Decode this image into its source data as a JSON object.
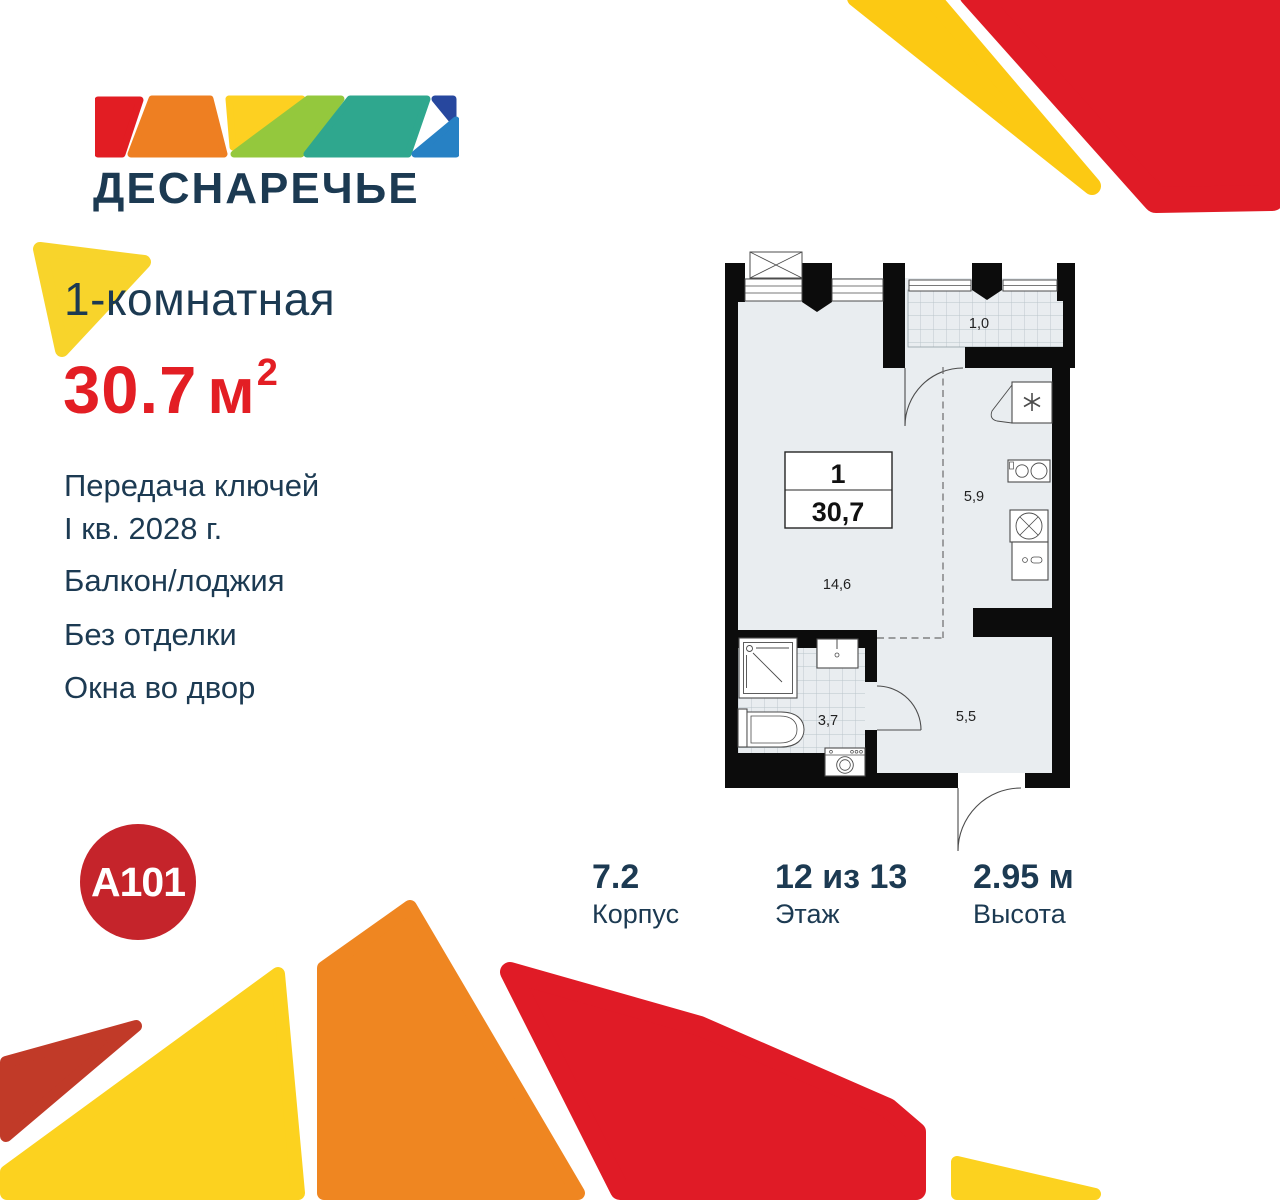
{
  "brand": {
    "project_name": "ДЕСНАРЕЧЬЕ",
    "developer_logo": "A101",
    "colors": {
      "navy": "#1c3a52",
      "accent_red": "#e31e24",
      "badge_red": "#c5242b",
      "yellow": "#fcd21f",
      "orange": "#ef8621",
      "brick": "#c13a28"
    }
  },
  "listing": {
    "title": "1-комнатная",
    "area_value": "30.7",
    "area_unit": "м",
    "area_exponent": "2",
    "features": [
      {
        "line1": "Передача ключей",
        "line2": "I кв. 2028 г."
      },
      {
        "line1": "Балкон/лоджия"
      },
      {
        "line1": "Без отделки"
      },
      {
        "line1": "Окна во двор"
      }
    ]
  },
  "plan": {
    "legend": {
      "rooms_count": "1",
      "total_area": "30,7"
    },
    "rooms": {
      "living": "14,6",
      "kitchen": "5,9",
      "bathroom": "3,7",
      "hallway": "5,5",
      "loggia": "1,0"
    }
  },
  "specs": [
    {
      "value": "7.2",
      "label": "Корпус"
    },
    {
      "value": "12 из 13",
      "label": "Этаж"
    },
    {
      "value": "2.95 м",
      "label": "Высота"
    }
  ]
}
